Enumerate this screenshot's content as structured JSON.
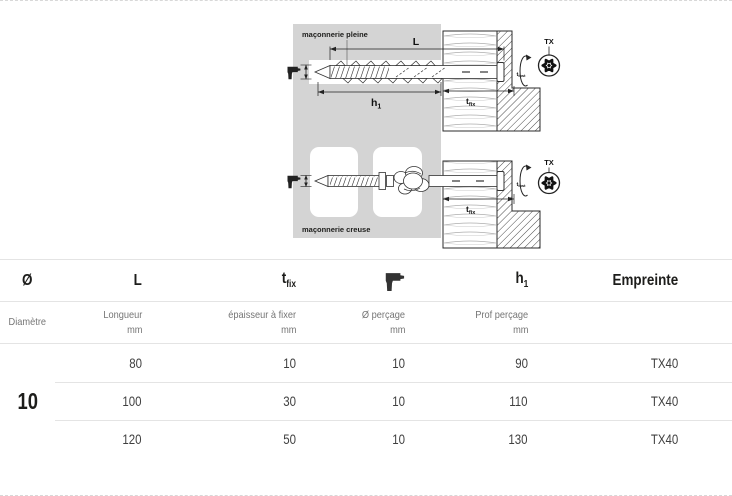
{
  "diagram": {
    "solid_masonry_label": "maçonnerie pleine",
    "hollow_masonry_label": "maçonnerie creuse",
    "dims": {
      "length": "L",
      "hole_depth_base": "h",
      "hole_depth_sub": "1",
      "fixture_base": "t",
      "fixture_sub": "fix",
      "install_base": "t",
      "install_sub": "inst",
      "drive": "TX"
    },
    "colors": {
      "panel_gray": "#d4d4d4",
      "linework": "#333333"
    }
  },
  "table": {
    "columns": [
      {
        "symbol": "Ø",
        "label": "Diamètre",
        "unit": ""
      },
      {
        "symbol": "L",
        "label": "Longueur",
        "unit": "mm"
      },
      {
        "symbol_base": "t",
        "symbol_sub": "fix",
        "label": "épaisseur à fixer",
        "unit": "mm"
      },
      {
        "symbol_icon": "drill-icon",
        "label": "Ø perçage",
        "unit": "mm"
      },
      {
        "symbol_base": "h",
        "symbol_sub": "1",
        "label": "Prof perçage",
        "unit": "mm"
      },
      {
        "symbol": "Empreinte",
        "label": "",
        "unit": ""
      }
    ],
    "diameter": "10",
    "rows": [
      {
        "length": "80",
        "tfix": "10",
        "drill": "10",
        "depth": "90",
        "drive": "TX40"
      },
      {
        "length": "100",
        "tfix": "30",
        "drill": "10",
        "depth": "110",
        "drive": "TX40"
      },
      {
        "length": "120",
        "tfix": "50",
        "drill": "10",
        "depth": "130",
        "drive": "TX40"
      }
    ]
  }
}
